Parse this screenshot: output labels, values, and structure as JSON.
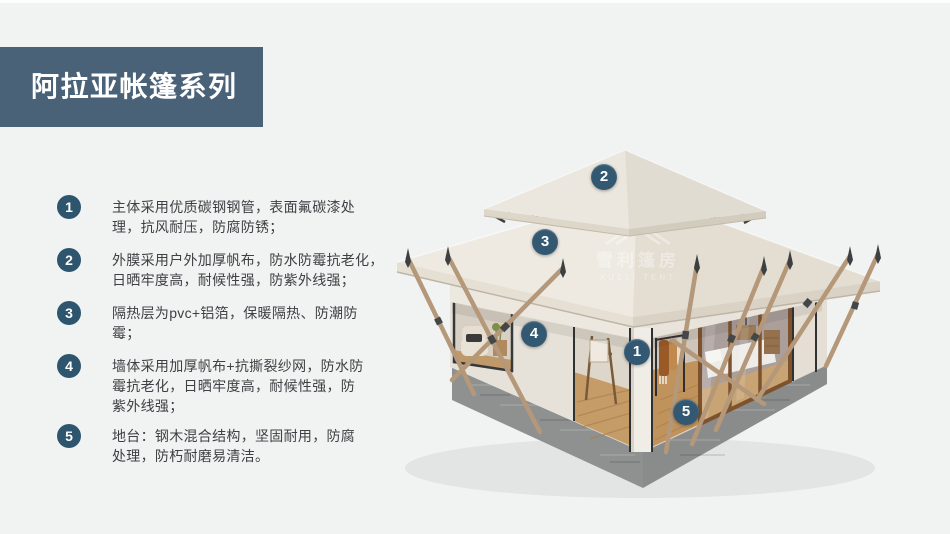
{
  "page": {
    "background": "#f1f2f2"
  },
  "banner": {
    "title": "阿拉亚帐篷系列",
    "bg": "#4a6278",
    "text_color": "#ffffff"
  },
  "features": [
    {
      "num": "1",
      "text": "主体采用优质碳钢钢管，表面氟碳漆处\n理，抗风耐压，防腐防锈；"
    },
    {
      "num": "2",
      "text": "外膜采用户外加厚帆布，防水防霉抗老化，\n日晒牢度高，耐候性强，防紫外线强；"
    },
    {
      "num": "3",
      "text": "隔热层为pvc+铝箔，保暖隔热、防潮防\n霉；"
    },
    {
      "num": "4",
      "text": "墙体采用加厚帆布+抗撕裂纱网，防水防\n霉抗老化，日晒牢度高，耐候性强，防\n紫外线强；"
    },
    {
      "num": "5",
      "text": "地台：钢木混合结构，坚固耐用，防腐\n处理，防朽耐磨易清洁。"
    }
  ],
  "markers": [
    {
      "num": "1"
    },
    {
      "num": "2"
    },
    {
      "num": "3"
    },
    {
      "num": "4"
    },
    {
      "num": "5"
    }
  ],
  "watermark": {
    "cn": "雪利篷房",
    "en": "XUELI TENT"
  },
  "colors": {
    "accent_blue": "#2e556e",
    "roof_canvas": "#eae6de",
    "wood_pole": "#b49879",
    "concrete_base": "#8e918f"
  }
}
